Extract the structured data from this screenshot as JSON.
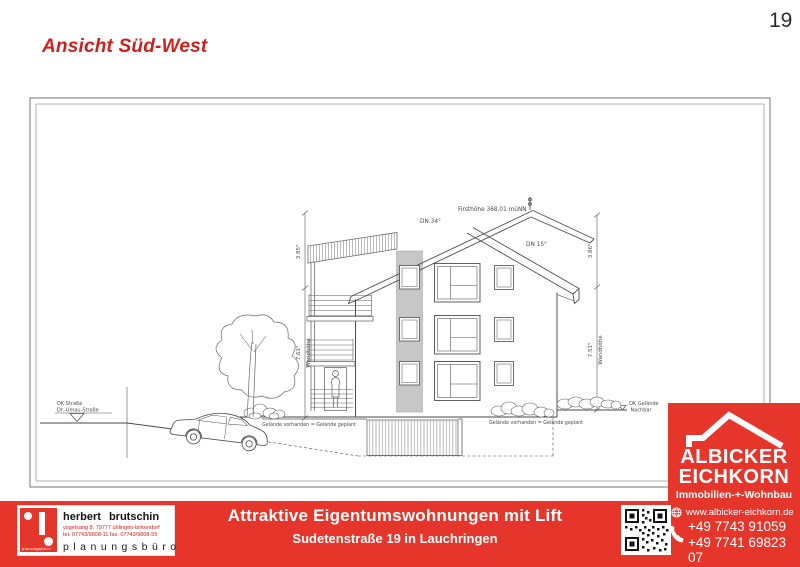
{
  "page": {
    "title": "Ansicht Süd-West",
    "number": "19"
  },
  "drawing": {
    "ridge_label": "Firsthöhe 368.01 müNN",
    "roof_pitch_left": "DN 34°",
    "roof_pitch_right": "DN 15°",
    "dims": {
      "left_upper": "3.85⁵",
      "left_lower": "7.61⁵",
      "left_lower_name": "Wandhöhe",
      "right_upper": "3.86⁵",
      "right_lower": "7.51⁵",
      "right_lower_name": "Wandhöhe"
    },
    "street_level_line1": "OK Straße",
    "street_level_line2": "Dr.-Umau-Straße",
    "ground_note_left": "Gelände vorhanden = Gelände geplant",
    "ground_note_right": "Gelände vorhanden = Gelände geplant",
    "neighbor_level_line1": "OK Gelände",
    "neighbor_level_line2": "Nachbar"
  },
  "footer": {
    "headline": "Attraktive Eigentumswohnungen mit Lift",
    "subheadline": "Sudetenstraße 19 in Lauchringen",
    "architect": {
      "name": "herbert brutschin",
      "address": "vogelsang 8, 79777 ühlingen-birkendorf",
      "phones": "tel. 07743/9808-11  fax. 07743/9808-55",
      "profession": "planungsbüro",
      "logo_caption": "planungsbüro"
    },
    "agency": {
      "name_line1": "ALBICKER",
      "name_line2": "EICHKORN",
      "tagline": "Immobilien-+-Wohnbau",
      "website": "www.albicker-eichkorn.de",
      "phone_1": "+49 7743 91059",
      "phone_2": "+49 7741 69823 07"
    }
  },
  "colors": {
    "brand_red": "#e6352a",
    "title_red": "#cf1f1c"
  }
}
